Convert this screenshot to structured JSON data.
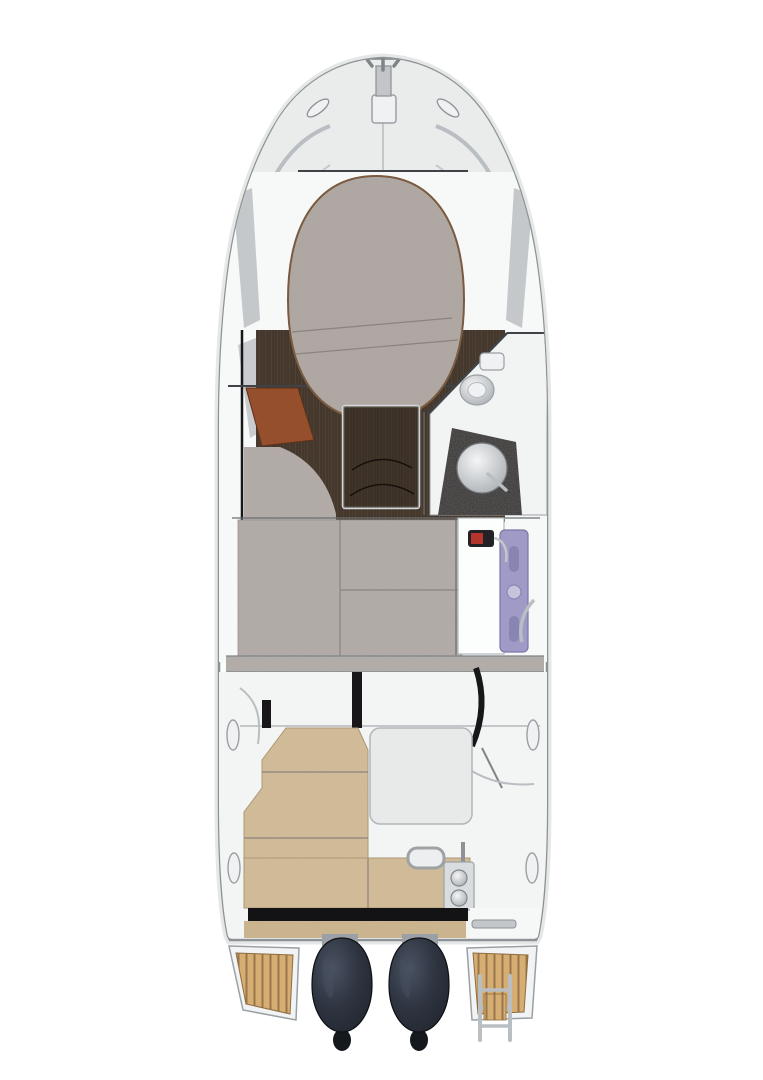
{
  "image": {
    "kind": "boat deck and interior plan, top-down cutaway illustration",
    "width_px": 763,
    "height_px": 1080,
    "background": "#ffffff",
    "visible_text": ""
  },
  "colors": {
    "background": "#ffffff",
    "hull_fill": "#fbfcfc",
    "hull_line": "#8d9296",
    "hull_shadow": "#e3e5e6",
    "gunwale_line": "#aeb2b5",
    "deck_panel": "#eaecec",
    "cockpit_deck": "#f3f4f4",
    "cabin_floor_white": "#f7f8f8",
    "window_gray": "#9aa0a5",
    "berth_fabric": "#b2aaa5",
    "cushion_fabric": "#b6afaa",
    "band_gray": "#b7b1ad",
    "piping_brown": "#7a5b41",
    "wood_floor": "#44382d",
    "wood_grain": "#5c4c3c",
    "table_wood": "#332a22",
    "table_edge": "#d4d7d9",
    "mahogany": "#954f2c",
    "head_floor": "#f2f3f3",
    "counter_black": "#29292b",
    "porcelain": "#f4f5f6",
    "porcelain_shade": "#9aa0a5",
    "lavender": "#9f9bc6",
    "lavender_dark": "#7b77a6",
    "lavender_light": "#c6c3dd",
    "extinguisher_body": "#232327",
    "extinguisher_red": "#b5342b",
    "frame_black": "#17171a",
    "module_gray": "#e8eaea",
    "bench_tan": "#d9c19a",
    "bench_edge": "#b09a72",
    "transom_tan": "#d2b98e",
    "strip_black": "#131316",
    "plate_silver": "#dadddf",
    "teak": "#d6ae74",
    "teak_stripe": "#8e6c40",
    "platform_white": "#f2f3f4",
    "engine_body_dark": "#1e222b",
    "engine_body_mid": "#2e3440",
    "engine_highlight": "#4a5263",
    "engine_tip": "#15181d",
    "metal_light": "#c3c7ca",
    "fitting_white": "#eff1f2"
  },
  "parts": [
    {
      "id": "anchor-fitting",
      "label": "bow anchor and windlass"
    },
    {
      "id": "bow-rails",
      "label": "bow pulpit rails"
    },
    {
      "id": "foredeck",
      "label": "foredeck panels with cleats"
    },
    {
      "id": "v-berth",
      "label": "forward cabin berth cushion"
    },
    {
      "id": "cabin-sole",
      "label": "dark wood cabin sole"
    },
    {
      "id": "cabin-table",
      "label": "cabin table"
    },
    {
      "id": "step",
      "label": "mahogany step"
    },
    {
      "id": "head-toilet",
      "label": "head compartment toilet"
    },
    {
      "id": "head-sink",
      "label": "head sink on dark counter"
    },
    {
      "id": "mid-berth",
      "label": "mid cabin berth cushions"
    },
    {
      "id": "companionway-door",
      "label": "lavender companionway door"
    },
    {
      "id": "fire-extinguisher",
      "label": "fire extinguisher"
    },
    {
      "id": "cockpit",
      "label": "cockpit deck"
    },
    {
      "id": "cockpit-bench",
      "label": "L-shaped tan cockpit bench"
    },
    {
      "id": "stern-latches",
      "label": "stern locker latch plate"
    },
    {
      "id": "swim-platform-port",
      "label": "port teak swim platform"
    },
    {
      "id": "swim-platform-starboard",
      "label": "starboard teak swim platform with ladder"
    },
    {
      "id": "outboard-engines",
      "label": "twin outboard engines"
    },
    {
      "id": "cleats",
      "label": "mooring cleats"
    }
  ]
}
